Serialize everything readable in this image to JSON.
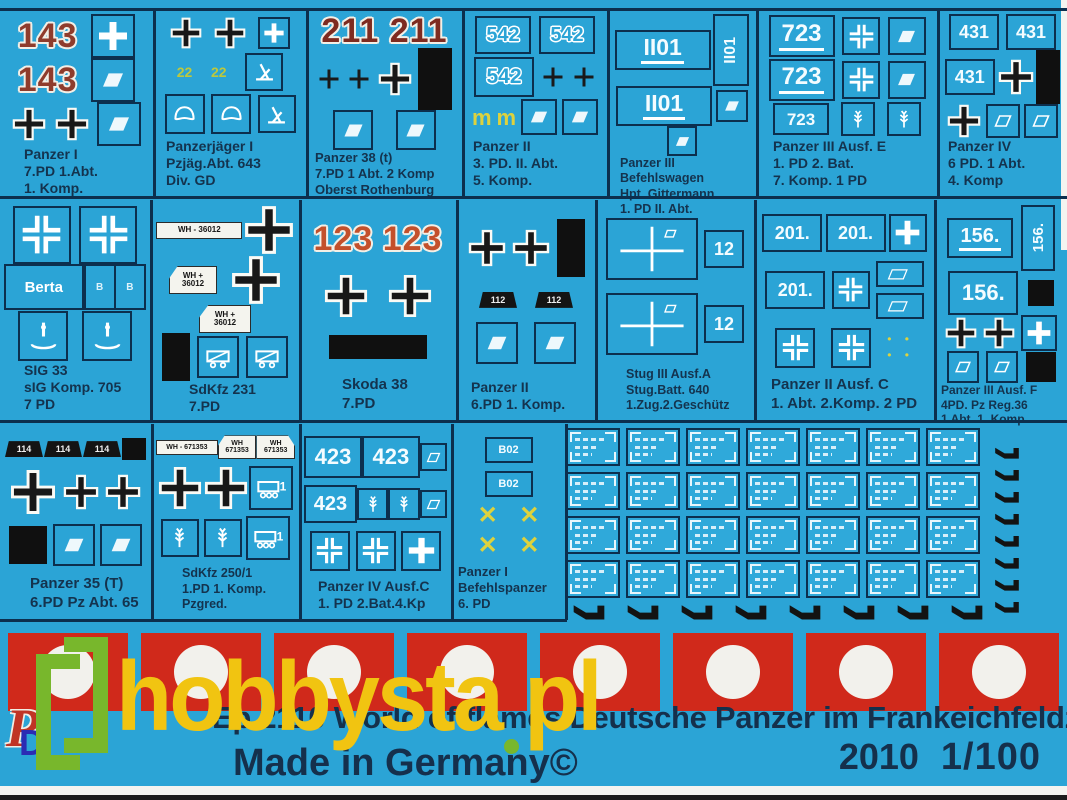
{
  "product": {
    "title": "Ep 2110 World of flames Deutsche Panzer im Frankeichfeldzuges No 1",
    "made_in": "Made in Germany©",
    "year": "2010",
    "scale": "1/100"
  },
  "watermark": {
    "text_main": "hobbysta",
    "text_tld": "pl"
  },
  "logo": {
    "p": "P",
    "d": "D"
  },
  "colors": {
    "sheet_cyan": "#2BA4D6",
    "flag_red": "#D0291B",
    "label_navy": "#14334E",
    "watermark_yellow": "#F1C411",
    "watermark_green": "#78B72C",
    "red_number": "#8F3C2C",
    "yellow_marking": "#DDD23E"
  },
  "flags": {
    "count": 8
  },
  "micro_plates": {
    "rows": 4,
    "cols": 7
  },
  "hooks": {
    "vertical": 8,
    "horizontal": 8
  },
  "cells": [
    {
      "id": "panzer-i",
      "x": 2,
      "y": 12,
      "w": 149,
      "h": 182,
      "lp": 22,
      "lfs": 14,
      "label": [
        "Panzer I",
        "7.PD 1.Abt.",
        "1. Komp."
      ],
      "rows": [
        [
          {
            "t": "rn",
            "v": "143"
          },
          {
            "t": "bx",
            "i": "wc",
            "w": 40
          }
        ],
        [
          {
            "t": "rn",
            "v": "143"
          },
          {
            "t": "bx",
            "i": "rh",
            "w": 40
          }
        ],
        [
          {
            "t": "bc",
            "w": 34
          },
          {
            "t": "bc",
            "w": 34
          },
          {
            "t": "bx",
            "i": "rh",
            "w": 40
          }
        ]
      ]
    },
    {
      "id": "panzerjaeger-i",
      "x": 156,
      "y": 12,
      "w": 148,
      "h": 182,
      "lp": 10,
      "lfs": 14,
      "label": [
        "Panzerjäger I",
        "Pzjäg.Abt. 643",
        "Div. GD"
      ],
      "rows": [
        [
          {
            "t": "bc",
            "w": 32
          },
          {
            "t": "bc",
            "w": 32
          },
          {
            "t": "bx",
            "i": "wc",
            "w": 28
          }
        ],
        [
          {
            "t": "yn",
            "v": "22"
          },
          {
            "t": "yn",
            "v": "22"
          },
          {
            "t": "bx",
            "i": "gun",
            "w": 34
          }
        ],
        [
          {
            "t": "bx",
            "i": "helm",
            "w": 36
          },
          {
            "t": "bx",
            "i": "helm",
            "w": 36
          },
          {
            "t": "bx",
            "i": "gun",
            "w": 34
          }
        ]
      ]
    },
    {
      "id": "panzer-38t",
      "x": 309,
      "y": 12,
      "w": 151,
      "h": 182,
      "lp": 6,
      "lfs": 13,
      "label": [
        "Panzer 38 (t)",
        "7.PD 1 Abt. 2 Komp",
        "Oberst Rothenburg"
      ],
      "rows": [
        [
          {
            "t": "rn",
            "v": "211",
            "c": "#7e2b20"
          },
          {
            "t": "rn",
            "v": "211",
            "c": "#7e2b20"
          }
        ],
        [
          {
            "t": "tc"
          },
          {
            "t": "tc"
          },
          {
            "t": "bc",
            "w": 34
          },
          {
            "t": "br",
            "w": 34,
            "h": 62
          }
        ],
        [
          {
            "t": "bx",
            "i": "rh",
            "w": 36
          },
          {
            "t": "bx",
            "i": "rh",
            "w": 36
          }
        ]
      ]
    },
    {
      "id": "panzer-ii-3pd",
      "x": 465,
      "y": 12,
      "w": 140,
      "h": 182,
      "lp": 8,
      "lfs": 14,
      "label": [
        "Panzer II",
        "3. PD. II. Abt.",
        "5. Komp."
      ],
      "rows": [
        [
          {
            "t": "nb",
            "v": "542",
            "o": 1,
            "w": 52,
            "h": 34,
            "fs": 20
          },
          {
            "t": "nb",
            "v": "542",
            "o": 1,
            "w": 52,
            "h": 34,
            "fs": 20
          }
        ],
        [
          {
            "t": "nb",
            "v": "542",
            "o": 1,
            "w": 56,
            "h": 36,
            "fs": 21
          },
          {
            "t": "tc"
          },
          {
            "t": "tc"
          }
        ],
        [
          {
            "t": "ym"
          },
          {
            "t": "ym"
          },
          {
            "t": "bx",
            "i": "rh",
            "w": 32
          },
          {
            "t": "bx",
            "i": "rh",
            "w": 32
          }
        ]
      ]
    },
    {
      "id": "panzer-iii-befehlswagen",
      "x": 610,
      "y": 12,
      "w": 144,
      "h": 182,
      "lp": 10,
      "lfs": 12.5,
      "label": [
        "Panzer III",
        "Befehlswagen",
        "Hpt. Gittermann",
        "1. PD  II. Abt."
      ],
      "rows": [
        [
          {
            "t": "nb",
            "v": "II01",
            "u": 1,
            "w": 92,
            "h": 36,
            "fs": 23
          },
          {
            "t": "nv",
            "v": "II01",
            "w": 32,
            "h": 68,
            "fs": 16
          }
        ],
        [
          {
            "t": "nb",
            "v": "II01",
            "u": 1,
            "w": 92,
            "h": 36,
            "fs": 23
          },
          {
            "t": "bx",
            "i": "rh",
            "w": 28
          }
        ],
        [
          {
            "t": "bx",
            "i": "rh",
            "w": 26
          }
        ]
      ]
    },
    {
      "id": "panzer-iii-ausf-e",
      "x": 759,
      "y": 12,
      "w": 176,
      "h": 182,
      "lp": 14,
      "lfs": 14,
      "label": [
        "Panzer III Ausf. E",
        "1. PD 2. Bat.",
        "7. Komp. 1 PD"
      ],
      "rows": [
        [
          {
            "t": "nb",
            "v": "723",
            "u": 1,
            "w": 62,
            "h": 38,
            "fs": 24
          },
          {
            "t": "bx",
            "i": "bk",
            "w": 34
          },
          {
            "t": "bx",
            "i": "rh",
            "w": 34
          }
        ],
        [
          {
            "t": "nb",
            "v": "723",
            "u": 1,
            "w": 62,
            "h": 38,
            "fs": 24
          },
          {
            "t": "bx",
            "i": "bk",
            "w": 34
          },
          {
            "t": "bx",
            "i": "rh",
            "w": 34
          }
        ],
        [
          {
            "t": "nb",
            "v": "723",
            "w": 52,
            "h": 28,
            "fs": 17
          },
          {
            "t": "bx",
            "i": "oak",
            "w": 30
          },
          {
            "t": "bx",
            "i": "oak",
            "w": 30
          }
        ]
      ]
    },
    {
      "id": "panzer-iv-6pd",
      "x": 940,
      "y": 12,
      "w": 125,
      "h": 182,
      "lp": 8,
      "lfs": 14,
      "label": [
        "Panzer IV",
        "6 PD. 1 Abt.",
        "4. Komp"
      ],
      "rows": [
        [
          {
            "t": "nb",
            "v": "431",
            "w": 46,
            "h": 32,
            "fs": 18
          },
          {
            "t": "nb",
            "v": "431",
            "w": 46,
            "h": 32,
            "fs": 18
          }
        ],
        [
          {
            "t": "nb",
            "v": "431",
            "w": 46,
            "h": 32,
            "fs": 18
          },
          {
            "t": "bc",
            "w": 36
          },
          {
            "t": "br",
            "w": 24,
            "h": 54
          }
        ],
        [
          {
            "t": "bc",
            "w": 34
          },
          {
            "t": "bx",
            "i": "ro",
            "w": 30
          },
          {
            "t": "bx",
            "i": "ro",
            "w": 30
          }
        ]
      ]
    },
    {
      "id": "sig-33",
      "x": 2,
      "y": 203,
      "w": 146,
      "h": 215,
      "lp": 22,
      "lfs": 14,
      "label": [
        "SIG 33",
        "sIG Komp. 705",
        "7 PD"
      ],
      "rows": [
        [
          {
            "t": "bx",
            "i": "bk",
            "w": 54
          },
          {
            "t": "bx",
            "i": "bk",
            "w": 54
          }
        ],
        [
          {
            "t": "tb",
            "v": "Berta",
            "w": 80,
            "h": 42,
            "fs": 15
          },
          {
            "t": "sb"
          }
        ],
        [
          {
            "t": "bx",
            "i": "sig",
            "w": 46
          },
          {
            "t": "bx",
            "i": "sig",
            "w": 46
          }
        ]
      ]
    },
    {
      "id": "sdkfz-231",
      "x": 153,
      "y": 203,
      "w": 144,
      "h": 215,
      "lp": 36,
      "lfs": 14,
      "label": [
        "SdKfz 231",
        "7.PD"
      ],
      "rows": [
        [
          {
            "t": "pw",
            "v": "WH - 36012",
            "w": 84,
            "h": 15,
            "fs": 8
          },
          {
            "t": "bc",
            "w": 50
          }
        ],
        [
          {
            "t": "pw",
            "l2": [
              "WH +",
              "36012"
            ],
            "shape": "p",
            "w": 46,
            "h": 26,
            "fs": 8
          },
          {
            "t": "bc",
            "w": 50
          }
        ],
        [
          {
            "t": "pw",
            "l2": [
              "WH +",
              "36012"
            ],
            "shape": "p",
            "w": 50,
            "h": 26,
            "fs": 8
          }
        ],
        [
          {
            "t": "br",
            "w": 28,
            "h": 48
          },
          {
            "t": "bx",
            "i": "car",
            "w": 38
          },
          {
            "t": "bx",
            "i": "car",
            "w": 38
          }
        ]
      ]
    },
    {
      "id": "skoda-38",
      "x": 302,
      "y": 203,
      "w": 152,
      "h": 215,
      "lp": 40,
      "lfs": 15,
      "label": [
        "Skoda 38",
        "7.PD"
      ],
      "rows": [
        [
          {
            "t": "rn",
            "v": "123",
            "c": "#c3502b"
          },
          {
            "t": "rn",
            "v": "123",
            "c": "#c3502b"
          }
        ],
        [
          {
            "t": "bc",
            "w": 44
          },
          {
            "t": "bc",
            "w": 44
          }
        ],
        [
          {
            "t": "br",
            "w": 98,
            "h": 24
          }
        ]
      ]
    },
    {
      "id": "panzer-ii-6pd",
      "x": 459,
      "y": 203,
      "w": 134,
      "h": 215,
      "lp": 12,
      "lfs": 14,
      "label": [
        "Panzer II",
        "6.PD 1. Komp."
      ],
      "rows": [
        [
          {
            "t": "bc",
            "w": 38
          },
          {
            "t": "bc",
            "w": 38
          },
          {
            "t": "br",
            "w": 28,
            "h": 58
          }
        ],
        [
          {
            "t": "pb",
            "v": "112"
          },
          {
            "t": "pb",
            "v": "112"
          }
        ],
        [
          {
            "t": "bx",
            "i": "rh",
            "w": 38
          },
          {
            "t": "bx",
            "i": "rh",
            "w": 38
          }
        ]
      ]
    },
    {
      "id": "stug-iii",
      "x": 598,
      "y": 203,
      "w": 154,
      "h": 215,
      "lp": 28,
      "lfs": 12.5,
      "label": [
        "Stug III Ausf.A",
        "Stug.Batt. 640",
        "1.Zug.2.Geschütz"
      ],
      "rows": [
        [
          {
            "t": "btc"
          },
          {
            "t": "nb",
            "v": "12",
            "w": 36,
            "h": 34,
            "fs": 18
          }
        ],
        [
          {
            "t": "btc"
          },
          {
            "t": "nb",
            "v": "12",
            "w": 36,
            "h": 34,
            "fs": 18
          }
        ]
      ]
    },
    {
      "id": "panzer-ii-ausf-c",
      "x": 757,
      "y": 203,
      "w": 175,
      "h": 215,
      "lp": 14,
      "lfs": 15,
      "label": [
        "Panzer II Ausf. C",
        "1. Abt. 2.Komp. 2 PD"
      ],
      "rows": [
        [
          {
            "t": "nb",
            "v": "201.",
            "w": 56,
            "h": 34,
            "fs": 18
          },
          {
            "t": "nb",
            "v": "201.",
            "w": 56,
            "h": 34,
            "fs": 18
          },
          {
            "t": "bx",
            "i": "wc",
            "w": 34
          }
        ],
        [
          {
            "t": "nb",
            "v": "201.",
            "w": 56,
            "h": 34,
            "fs": 18
          },
          {
            "t": "bx",
            "i": "bk",
            "w": 34
          },
          {
            "t": "col",
            "items": [
              {
                "t": "rp"
              },
              {
                "t": "rp"
              }
            ]
          }
        ],
        [
          {
            "t": "bx",
            "i": "bk",
            "w": 36
          },
          {
            "t": "bx",
            "i": "bk",
            "w": 36
          },
          {
            "t": "col",
            "items": [
              {
                "t": "yd"
              },
              {
                "t": "yd"
              }
            ]
          }
        ]
      ]
    },
    {
      "id": "panzer-iii-ausf-f",
      "x": 937,
      "y": 203,
      "w": 128,
      "h": 215,
      "lp": 4,
      "lfs": 12,
      "label": [
        "Panzer III Ausf. F",
        "4PD. Pz Reg.36",
        "1 Abt. 1. Komp."
      ],
      "rows": [
        [
          {
            "t": "nb",
            "v": "156.",
            "u": 1,
            "w": 62,
            "h": 36,
            "fs": 20
          },
          {
            "t": "nv",
            "v": "156.",
            "w": 30,
            "h": 62,
            "fs": 15
          }
        ],
        [
          {
            "t": "nb",
            "v": "156.",
            "w": 66,
            "h": 40,
            "fs": 22
          },
          {
            "t": "br",
            "w": 26,
            "h": 26
          }
        ],
        [
          {
            "t": "bc",
            "w": 32
          },
          {
            "t": "bc",
            "w": 32
          },
          {
            "t": "bx",
            "i": "wc",
            "w": 32
          }
        ],
        [
          {
            "t": "bx",
            "i": "ro",
            "w": 28
          },
          {
            "t": "bx",
            "i": "ro",
            "w": 28
          },
          {
            "t": "br",
            "w": 30,
            "h": 30
          }
        ]
      ]
    },
    {
      "id": "panzer-35t",
      "x": 2,
      "y": 427,
      "w": 147,
      "h": 190,
      "lp": 28,
      "lfs": 15,
      "label": [
        "Panzer 35 (T)",
        "6.PD Pz Abt. 65"
      ],
      "rows": [
        [
          {
            "t": "pb",
            "v": "114"
          },
          {
            "t": "pb",
            "v": "114"
          },
          {
            "t": "pb",
            "v": "114"
          },
          {
            "t": "br",
            "w": 24,
            "h": 22
          }
        ],
        [
          {
            "t": "bc",
            "w": 46
          },
          {
            "t": "bc",
            "w": 36
          },
          {
            "t": "bc",
            "w": 36
          }
        ],
        [
          {
            "t": "br",
            "w": 38,
            "h": 38
          },
          {
            "t": "bx",
            "i": "rh",
            "w": 38
          },
          {
            "t": "bx",
            "i": "rh",
            "w": 38
          }
        ]
      ]
    },
    {
      "id": "sdkfz-250-1",
      "x": 154,
      "y": 427,
      "w": 143,
      "h": 190,
      "lp": 28,
      "lfs": 12.5,
      "label": [
        "SdKfz 250/1",
        "1.PD 1. Komp.",
        "Pzgred."
      ],
      "rows": [
        [
          {
            "t": "pw",
            "v": "WH - 671353",
            "w": 62,
            "h": 13,
            "fs": 7
          },
          {
            "t": "pw",
            "l2": [
              "WH",
              "671353"
            ],
            "shape": "p",
            "w": 38,
            "h": 22,
            "fs": 7
          },
          {
            "t": "pw",
            "l2": [
              "WH",
              "671353"
            ],
            "shape": "q",
            "w": 38,
            "h": 22,
            "fs": 7
          }
        ],
        [
          {
            "t": "bc",
            "w": 44
          },
          {
            "t": "bc",
            "w": 44
          },
          {
            "t": "bx",
            "i": "ht",
            "w": 40
          }
        ],
        [
          {
            "t": "bx",
            "i": "oak",
            "w": 34
          },
          {
            "t": "bx",
            "i": "oak",
            "w": 34
          },
          {
            "t": "bx",
            "i": "ht",
            "w": 40
          }
        ]
      ]
    },
    {
      "id": "panzer-iv-ausf-c",
      "x": 302,
      "y": 427,
      "w": 147,
      "h": 190,
      "lp": 16,
      "lfs": 14,
      "label": [
        "Panzer IV Ausf.C",
        "1. PD 2.Bat.4.Kp"
      ],
      "rows": [
        [
          {
            "t": "nb",
            "v": "423",
            "w": 56,
            "h": 38,
            "fs": 22
          },
          {
            "t": "nb",
            "v": "423",
            "w": 56,
            "h": 38,
            "fs": 22
          },
          {
            "t": "bx",
            "i": "ro",
            "w": 24
          }
        ],
        [
          {
            "t": "nb",
            "v": "423",
            "w": 50,
            "h": 34,
            "fs": 20
          },
          {
            "t": "bx",
            "i": "oak",
            "w": 28
          },
          {
            "t": "bx",
            "i": "oak",
            "w": 28
          },
          {
            "t": "bx",
            "i": "ro",
            "w": 24
          }
        ],
        [
          {
            "t": "bx",
            "i": "bk",
            "w": 36
          },
          {
            "t": "bx",
            "i": "bk",
            "w": 36
          },
          {
            "t": "bx",
            "i": "wc",
            "w": 36
          }
        ]
      ]
    },
    {
      "id": "panzer-i-befehlspanzer",
      "x": 454,
      "y": 427,
      "w": 109,
      "h": 190,
      "lp": 4,
      "lfs": 13,
      "label": [
        "Panzer I",
        "Befehlspanzer",
        "6. PD"
      ],
      "rows": [
        [
          {
            "t": "nb",
            "v": "B02",
            "w": 44,
            "h": 22,
            "fs": 11
          }
        ],
        [
          {
            "t": "nb",
            "v": "B02",
            "w": 44,
            "h": 22,
            "fs": 11
          }
        ],
        [
          {
            "t": "yx"
          },
          {
            "t": "yx"
          }
        ],
        [
          {
            "t": "yx"
          },
          {
            "t": "yx"
          }
        ]
      ]
    }
  ]
}
